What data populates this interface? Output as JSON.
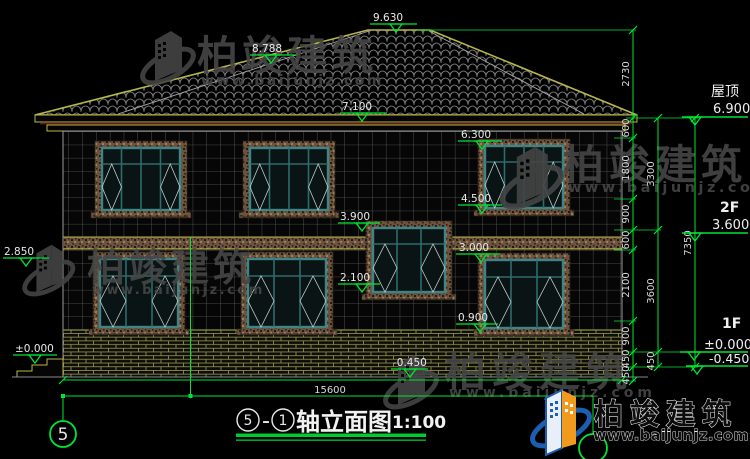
{
  "colors": {
    "annotation_green": "#00e532",
    "cad_yellow": "#b9b64a",
    "window_teal": "#3f8585",
    "trim_brown": "#6e5640",
    "mortar_olive": "#8f9040",
    "eave_red": "#6e1616",
    "watermark_gray": "#474747",
    "logo_blue": "#1c5fb0",
    "logo_orange": "#f29a1d"
  },
  "watermark": {
    "brand": "柏竣建筑",
    "url": "www.baijunjz.com"
  },
  "brand_logo": {
    "brand": "柏竣建筑",
    "url": "www.baijunjz.com"
  },
  "title": {
    "axis_left": "5",
    "separator": "–",
    "axis_right": "1",
    "name": "轴立面图",
    "scale": "1:100"
  },
  "axis": {
    "left_bubble": "5"
  },
  "levels": {
    "ridge": "9.630",
    "hip": "8.788",
    "eave_top": "7.100",
    "f2_window_top": "6.300",
    "f2_window_sill": "4.500",
    "belt_top": "3.900",
    "belt_bottom": "3.000",
    "stair_window_sill": "2.100",
    "f1_window_sill": "0.900",
    "porch_left": "2.850",
    "ground_left": "±0.000",
    "base_mid": "-0.450"
  },
  "floor_labels": {
    "roof": "屋顶",
    "roof_level": "6.900",
    "f2": "2F",
    "f2_level": "3.600",
    "f1": "1F",
    "f1_level": "±0.000",
    "f1_minus": "-0.450"
  },
  "dims": {
    "chain1": [
      "2730",
      "600",
      "1800",
      "900",
      "600",
      "2100",
      "900",
      "450",
      "450"
    ],
    "chain2": [
      "3300",
      "3600",
      "450"
    ],
    "chain3": [
      "7350"
    ],
    "total_width": "15600"
  }
}
